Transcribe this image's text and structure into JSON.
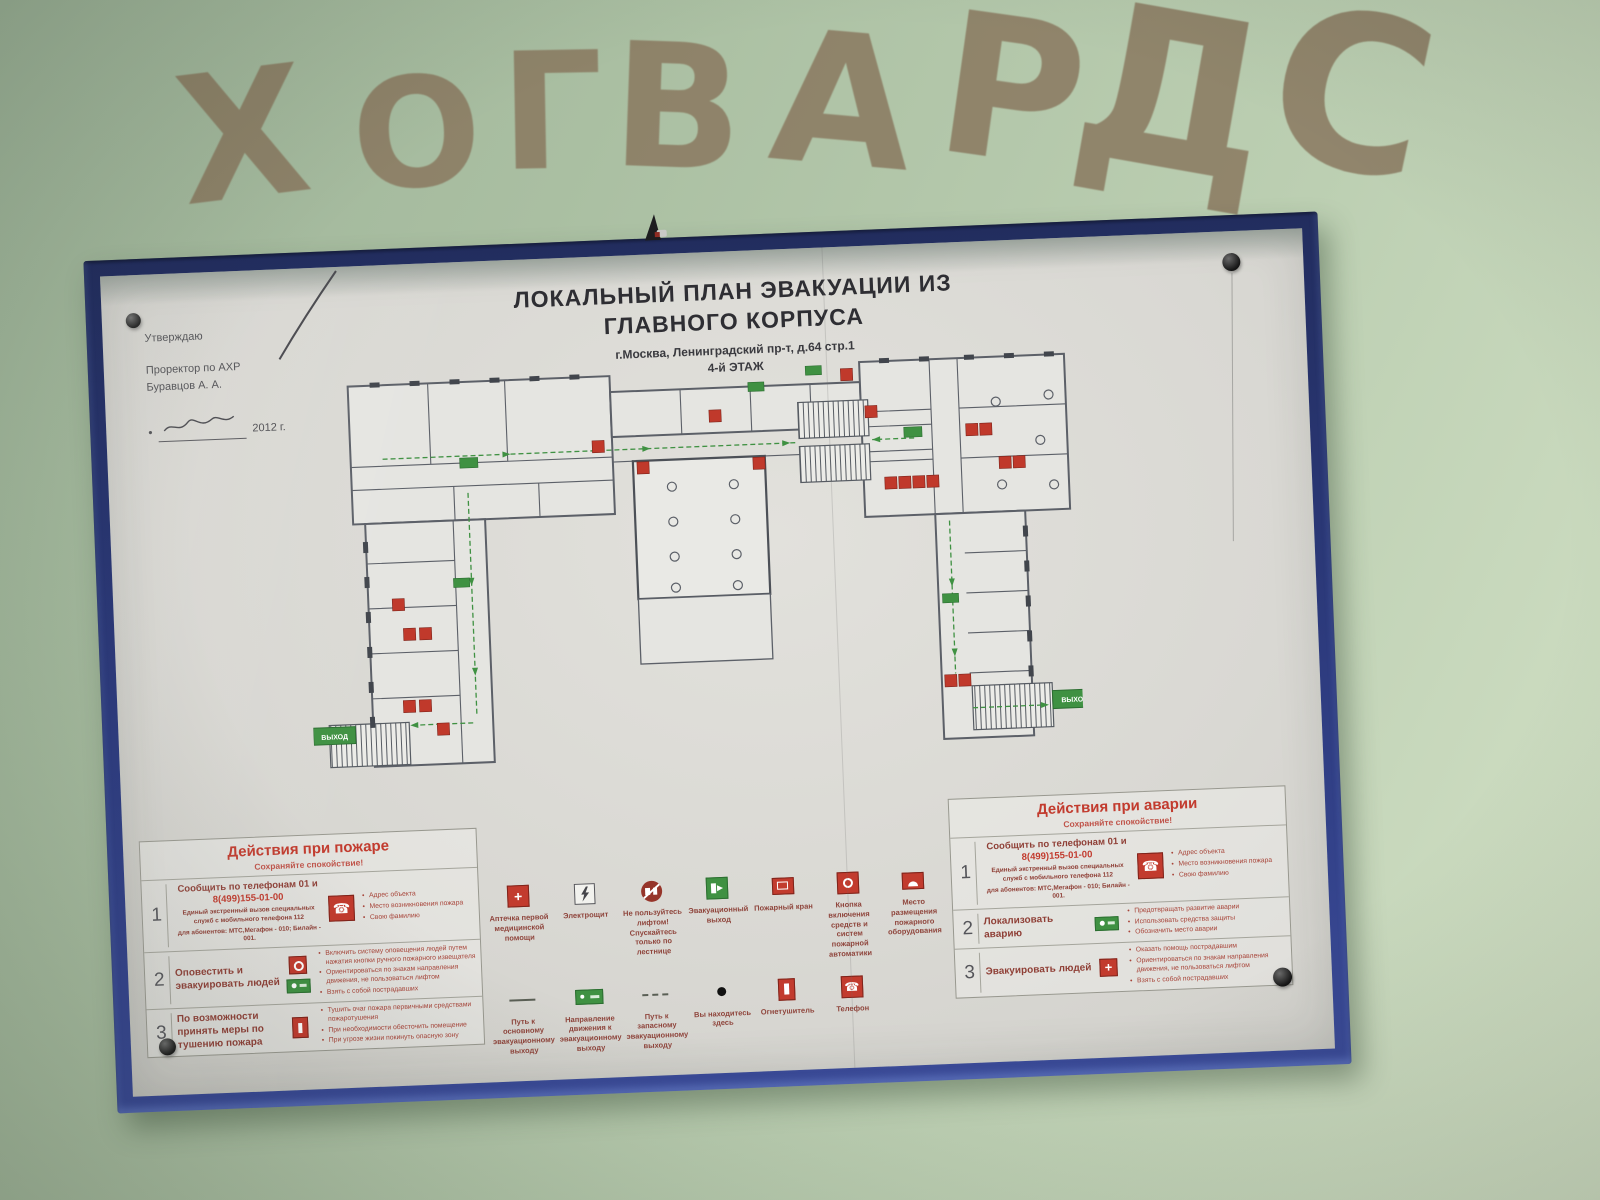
{
  "scene": {
    "graffiti_letters": [
      "Х",
      "О",
      "Г",
      "В",
      "А",
      "Р",
      "Д",
      "С"
    ]
  },
  "poster": {
    "approval": {
      "approve": "Утверждаю",
      "position": "Проректор по АХР",
      "name": "Буравцов А. А.",
      "date": "2012 г."
    },
    "title_line1": "ЛОКАЛЬНЫЙ ПЛАН ЭВАКУАЦИИ ИЗ",
    "title_line2": "ГЛАВНОГО КОРПУСА",
    "address": "г.Москва, Ленинградский пр-т, д.64 стр.1",
    "floor": "4-й ЭТАЖ",
    "plan": {
      "exit_label_left": "ВЫХОД",
      "exit_label_right": "ВЫХОД"
    },
    "fire_panel": {
      "title": "Действия при пожаре",
      "subtitle": "Сохраняйте спокойствие!",
      "rows": [
        {
          "num": "1",
          "call_title": "Сообщить по телефонам 01 и",
          "phone": "8(499)155-01-00",
          "note_a": "Единый экстренный вызов специальных служб с мобильного телефона 112",
          "note_b": "для абонентов: МТС,Мегафон - 010; Билайн - 001.",
          "bullets": [
            "Адрес объекта",
            "Место возникновения пожара",
            "Свою фамилию"
          ]
        },
        {
          "num": "2",
          "action": "Оповестить и эвакуировать людей",
          "bullets": [
            "Включить систему оповещения людей путем нажатия кнопки ручного пожарного извещателя",
            "Ориентироваться по знакам направления движения, не пользоваться лифтом",
            "Взять с собой пострадавших"
          ]
        },
        {
          "num": "3",
          "action": "По возможности принять меры по тушению пожара",
          "bullets": [
            "Тушить очаг пожара первичными средствами пожаротушения",
            "При необходимости обесточить помещение",
            "При угрозе жизни покинуть опасную зону"
          ]
        }
      ]
    },
    "accident_panel": {
      "title": "Действия при аварии",
      "subtitle": "Сохраняйте спокойствие!",
      "rows": [
        {
          "num": "1",
          "call_title": "Сообщить по телефонам 01 и",
          "phone": "8(499)155-01-00",
          "note_a": "Единый экстренный вызов специальных служб с мобильного телефона 112",
          "note_b": "для абонентов: МТС,Мегафон - 010; Билайн - 001.",
          "bullets": [
            "Адрес объекта",
            "Место возникновения пожара",
            "Свою фамилию"
          ]
        },
        {
          "num": "2",
          "action": "Локализовать аварию",
          "bullets": [
            "Предотвращать развитие аварии",
            "Использовать средства защиты",
            "Обозначить место аварии"
          ]
        },
        {
          "num": "3",
          "action": "Эвакуировать людей",
          "bullets": [
            "Оказать помощь пострадавшим",
            "Ориентироваться по знакам направления движения, не пользоваться лифтом",
            "Взять с собой пострадавших"
          ]
        }
      ]
    },
    "legend": {
      "row1": [
        {
          "label": "Аптечка первой медицинской помощи"
        },
        {
          "label": "Электрощит"
        },
        {
          "label": "Не пользуйтесь лифтом! Спускайтесь только по лестнице"
        },
        {
          "label": "Эвакуационный выход"
        },
        {
          "label": "Пожарный кран"
        },
        {
          "label": "Кнопка включения средств и систем пожарной автоматики"
        },
        {
          "label": "Место размещения пожарного оборудования"
        }
      ],
      "row2": [
        {
          "label": "Путь к основному эвакуационному выходу"
        },
        {
          "label": "Направление движения к эвакуационному выходу"
        },
        {
          "label": "Путь к запасному эвакуационному выходу"
        },
        {
          "label": "Вы находитесь здесь"
        },
        {
          "label": "Огнетушитель"
        },
        {
          "label": "Телефон"
        }
      ]
    }
  },
  "colors": {
    "wall": "#aabfa2",
    "frame_blue": "#2e3c80",
    "poster": "#d9d8d3",
    "accent_red": "#c23b2e",
    "accent_green": "#3f9142",
    "graffiti": "#8a7960"
  }
}
